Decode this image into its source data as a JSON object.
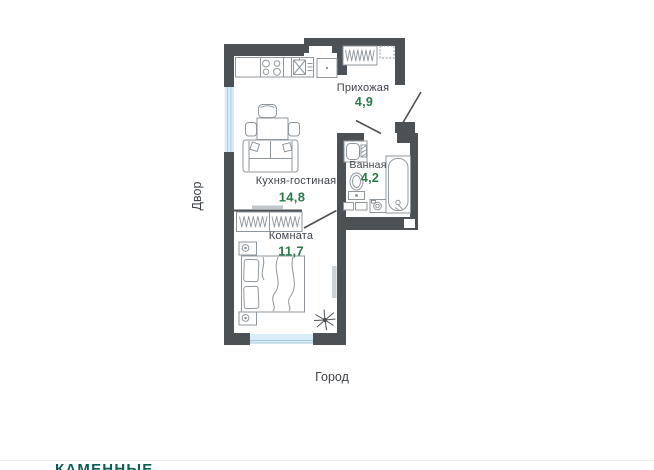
{
  "plan": {
    "rooms": [
      {
        "id": "hallway",
        "name": "Прихожая",
        "area": "4,9"
      },
      {
        "id": "bathroom",
        "name": "Ванная",
        "area": "4,2"
      },
      {
        "id": "kitchen_living",
        "name": "Кухня-гостиная",
        "area": "14,8"
      },
      {
        "id": "room",
        "name": "Комната",
        "area": "11,7"
      }
    ],
    "context": {
      "left_label": "Двор",
      "bottom_label": "Город"
    }
  },
  "branding": {
    "logo_text": "КАМЕННЫЕ"
  },
  "colors": {
    "wall": "#4c5156",
    "area_accent": "#2a7a4b",
    "window": "#d9edf8",
    "furniture_stroke": "#90979c",
    "logo": "#0c5f58",
    "label_text": "#3e434a",
    "divider": "#e8eaea"
  }
}
